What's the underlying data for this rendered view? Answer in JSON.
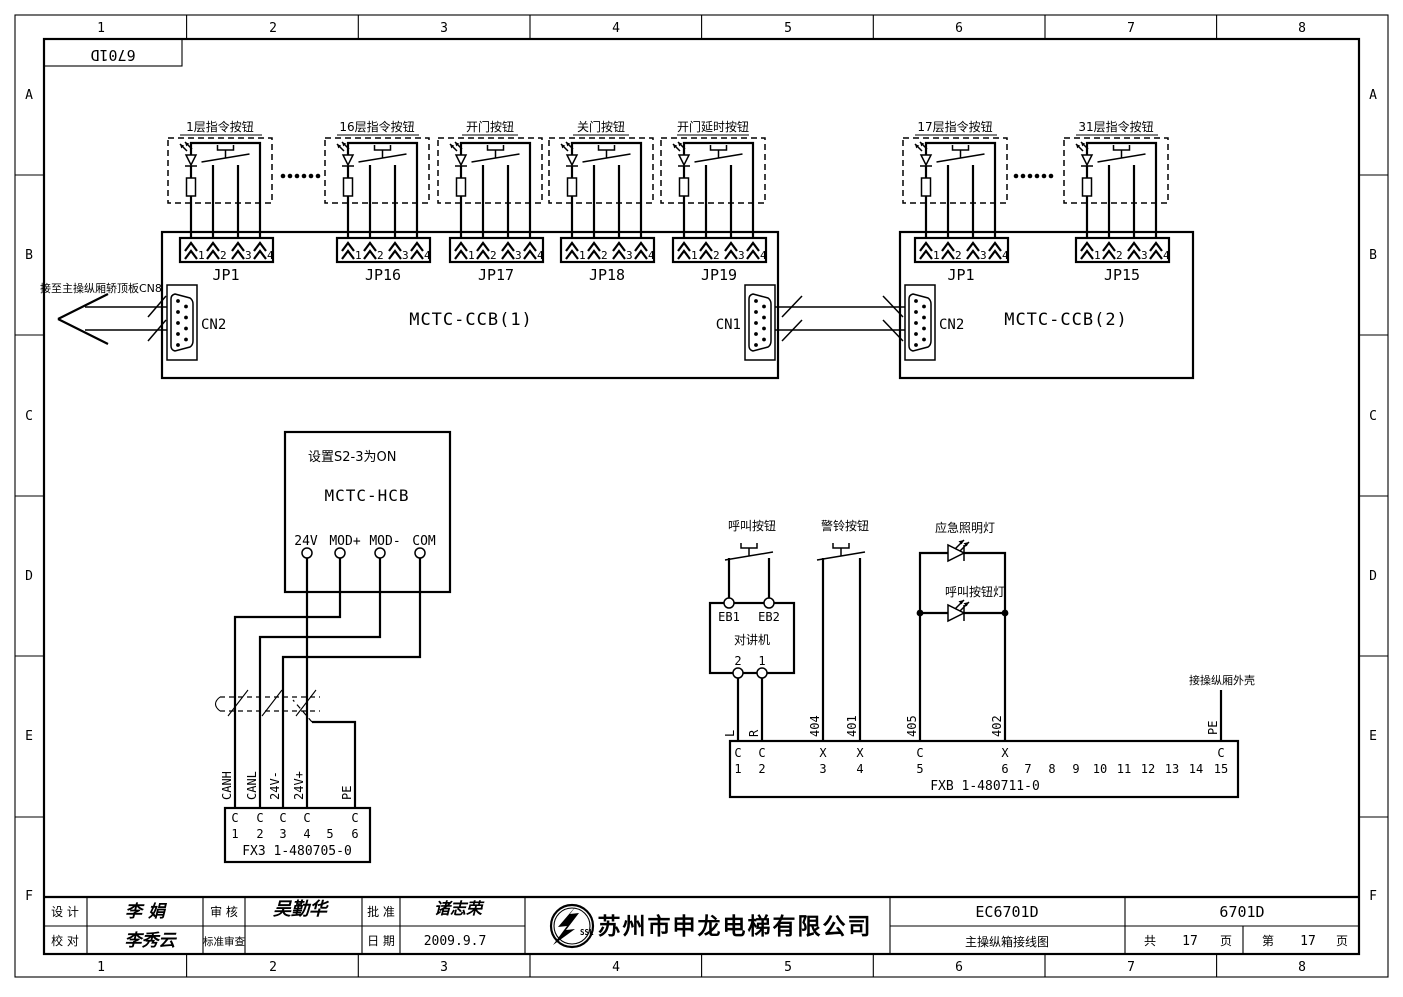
{
  "border": {
    "cols": [
      "1",
      "2",
      "3",
      "4",
      "5",
      "6",
      "7",
      "8"
    ],
    "rows": [
      "A",
      "B",
      "C",
      "D",
      "E",
      "F"
    ]
  },
  "frame_label": "6701D",
  "buttons": {
    "pin_numbers": [
      "1",
      "2",
      "3",
      "4"
    ],
    "units": [
      {
        "label": "1层指令按钮",
        "jp": "JP1"
      },
      {
        "label": "16层指令按钮",
        "jp": "JP16"
      },
      {
        "label": "开门按钮",
        "jp": "JP17"
      },
      {
        "label": "关门按钮",
        "jp": "JP18"
      },
      {
        "label": "开门延时按钮",
        "jp": "JP19"
      },
      {
        "label": "17层指令按钮",
        "jp": "JP1"
      },
      {
        "label": "31层指令按钮",
        "jp": "JP15"
      }
    ]
  },
  "boards": {
    "ccb1": {
      "name": "MCTC-CCB(1)",
      "cn_left": "CN2",
      "cn_right": "CN1"
    },
    "ccb2": {
      "name": "MCTC-CCB(2)",
      "cn_left": "CN2"
    },
    "left_note": "接至主操纵厢轿顶板CN8"
  },
  "hcb": {
    "note": "设置S2-3为ON",
    "name": "MCTC-HCB",
    "t1": "24V",
    "t2": "MOD+",
    "t3": "MOD-",
    "t4": "COM"
  },
  "fx3": {
    "title": "FX3 1-480705-0",
    "pins": [
      {
        "t": "C",
        "n": "1"
      },
      {
        "t": "C",
        "n": "2"
      },
      {
        "t": "C",
        "n": "3"
      },
      {
        "t": "C",
        "n": "4"
      },
      {
        "t": "",
        "n": "5"
      },
      {
        "t": "C",
        "n": "6"
      }
    ],
    "w1": "CANH",
    "w2": "CANL",
    "w3": "24V-",
    "w4": "24V+",
    "w5": "PE"
  },
  "right": {
    "call_button": "呼叫按钮",
    "alarm_button": "警铃按钮",
    "emergency_lamp": "应急照明灯",
    "call_lamp": "呼叫按钮灯",
    "shell_note": "接操纵厢外壳",
    "intercom": {
      "name": "对讲机",
      "eb1": "EB1",
      "eb2": "EB2",
      "p2": "2",
      "p1": "1"
    }
  },
  "fxb": {
    "title": "FXB 1-480711-0",
    "pins": [
      {
        "t": "C",
        "n": "1"
      },
      {
        "t": "C",
        "n": "2"
      },
      {
        "t": "X",
        "n": "3"
      },
      {
        "t": "X",
        "n": "4"
      },
      {
        "t": "C",
        "n": "5"
      },
      {
        "t": "X",
        "n": "6"
      },
      {
        "t": "",
        "n": "7"
      },
      {
        "t": "",
        "n": "8"
      },
      {
        "t": "",
        "n": "9"
      },
      {
        "t": "",
        "n": "10"
      },
      {
        "t": "",
        "n": "11"
      },
      {
        "t": "",
        "n": "12"
      },
      {
        "t": "",
        "n": "13"
      },
      {
        "t": "",
        "n": "14"
      },
      {
        "t": "C",
        "n": "15"
      }
    ],
    "wl": "L",
    "wr": "R",
    "w404": "404",
    "w401": "401",
    "w405": "405",
    "w402": "402",
    "wpe": "PE"
  },
  "titleblock": {
    "design_label": "设 计",
    "design_name": "李 娟",
    "check_label": "校 对",
    "check_name": "李秀云",
    "review_label": "审 核",
    "review_name": "吴勤华",
    "std_label": "标准审查",
    "approve_label": "批 准",
    "approve_name": "诸志荣",
    "date_label": "日 期",
    "date_value": "2009.9.7",
    "logo_text": "SSL",
    "company": "苏州市申龙电梯有限公司",
    "doc_code": "EC6701D",
    "doc_title": "主操纵箱接线图",
    "drawing_no": "6701D",
    "pages_total_label": "共",
    "pages_total": "17",
    "pages_unit1": "页",
    "page_seq_label": "第",
    "page_seq": "17",
    "pages_unit2": "页"
  }
}
